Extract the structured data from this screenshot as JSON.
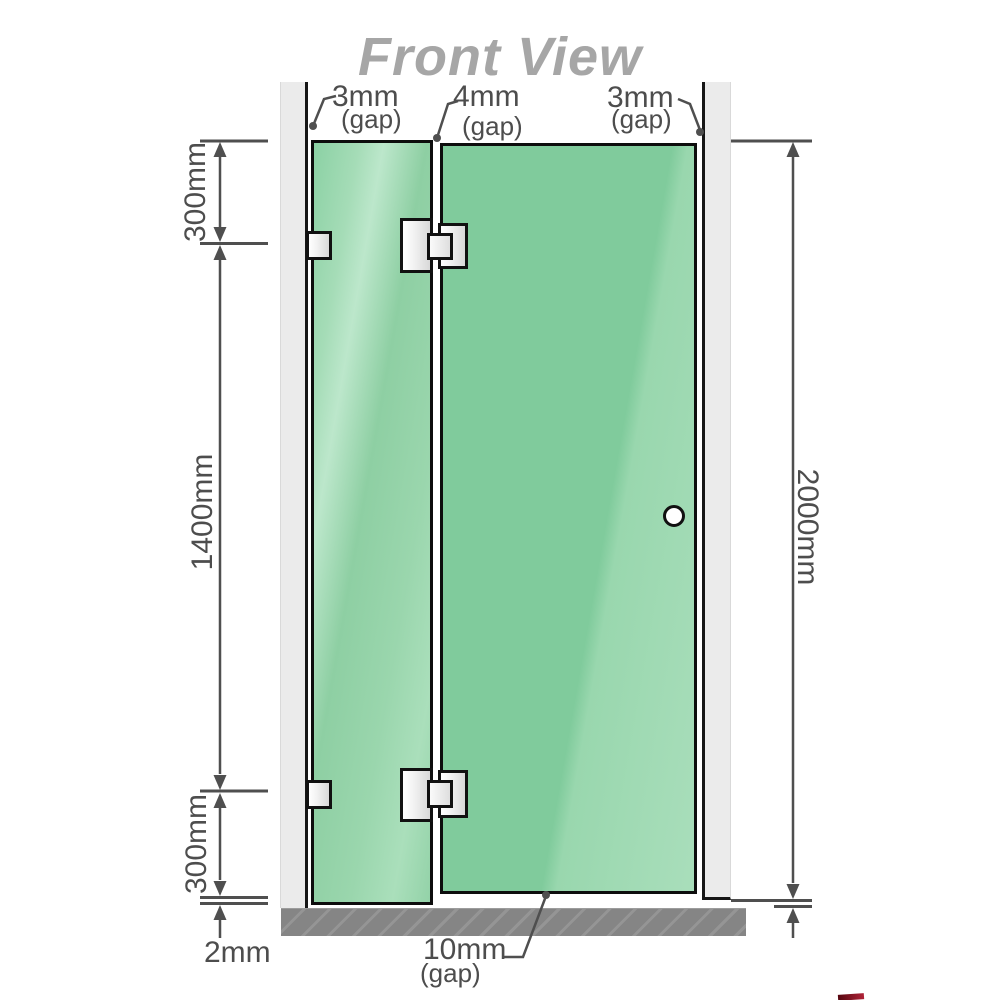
{
  "title": "Front View",
  "diagram": {
    "kind": "shower-screen-front-elevation",
    "top_gaps": [
      {
        "value": "3mm",
        "note": "(gap)"
      },
      {
        "value": "4mm",
        "note": "(gap)"
      },
      {
        "value": "3mm",
        "note": "(gap)"
      }
    ],
    "left_dimensions": [
      {
        "value": "300mm"
      },
      {
        "value": "1400mm"
      },
      {
        "value": "300mm"
      }
    ],
    "bottom_left_dimension": {
      "value": "2mm"
    },
    "right_dimension": {
      "value": "2000mm"
    },
    "bottom_gap": {
      "value": "10mm",
      "note": "(gap)"
    }
  },
  "colors": {
    "glass_green": "#80cb9c",
    "glass_highlight": "#bce7cb",
    "wall_gray": "#ebebeb",
    "floor_gray": "#858585",
    "dimension_line": "#4f4f4f",
    "title_gray": "#a6a6a6",
    "hardware_outline": "#111111",
    "watermark_red": "#8e1225"
  }
}
